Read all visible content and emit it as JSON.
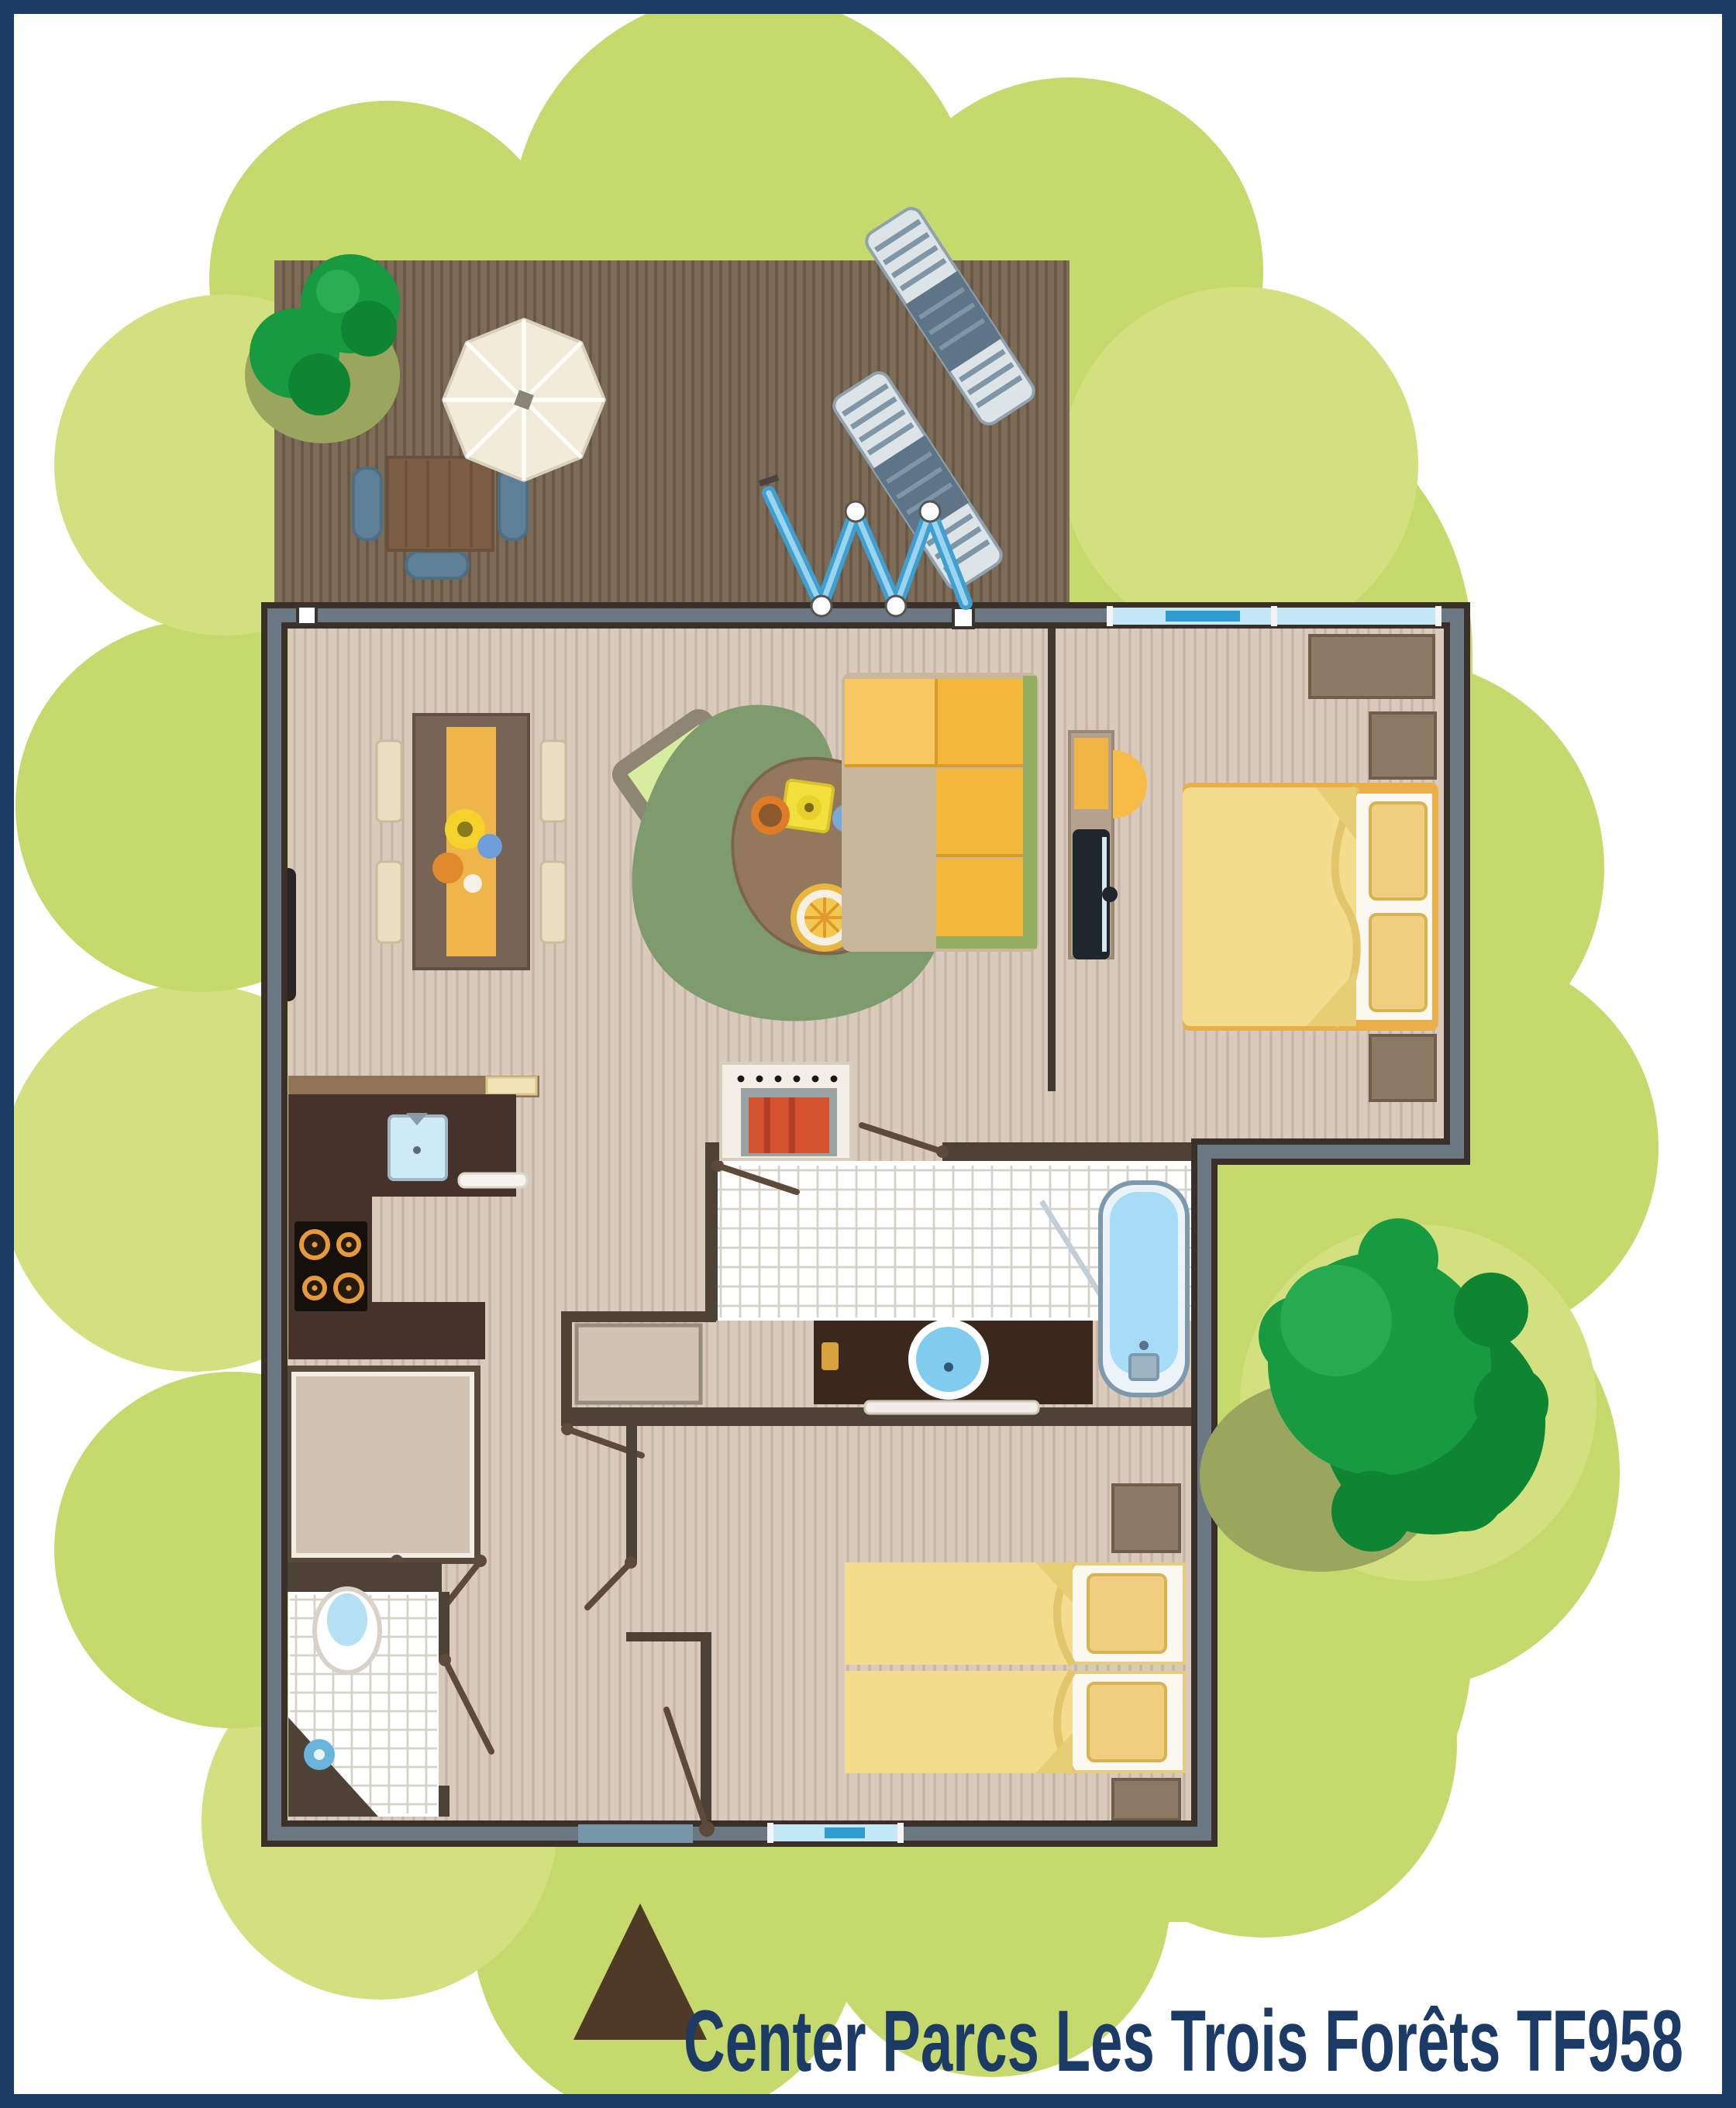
{
  "caption": {
    "text": "Center Parcs Les Trois Forêts TF958",
    "color": "#1b3a66"
  },
  "palette": {
    "navy": "#1b3a66",
    "garden": "#c6d96d",
    "garden-light": "#d2e07f",
    "olive": "#9aa65e",
    "deck": "#7c6b57",
    "deck-stripe": "#675643",
    "floor": "#d9cabc",
    "floor-stripe": "#c7b4a7",
    "wall-dark": "#383029",
    "wall-slate": "#6b7883",
    "wall-brown": "#4e4237",
    "window": "#c5e8f7",
    "window-accent": "#2f9cd1",
    "espresso": "#45322a",
    "wood": "#8d7a64",
    "wood-dark": "#6f5e4b",
    "beige": "#d2c2b1",
    "cream": "#eadfc0",
    "amber": "#f5b83d",
    "amber-light": "#f8c75f",
    "runner": "#eeb54a",
    "duvet": "#f3dc8e",
    "pillow": "#f0d080",
    "rug": "#7e9b6e",
    "water": "#a6dcf5",
    "tree": "#189a40",
    "tree-dark": "#0f8433",
    "sofa-green": "#93ad62",
    "fire-red": "#d4522e",
    "lounger": "#5d7587",
    "accordion": "#3f9fd0",
    "door-brown": "#5d4a3a",
    "slate-door": "#7496a8"
  }
}
